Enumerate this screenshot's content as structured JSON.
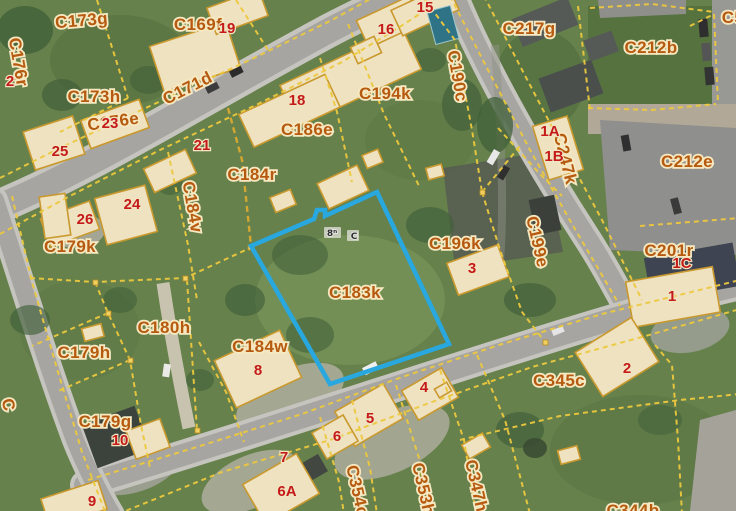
{
  "map": {
    "type": "cadastral-aerial-map",
    "highlight_parcel": {
      "label": "C183k",
      "outline_color": "#29a8e0"
    },
    "parcel_labels": [
      {
        "text": "C173g",
        "x": 82,
        "y": 26,
        "rot": -5
      },
      {
        "text": "C169f",
        "x": 198,
        "y": 30,
        "rot": 0
      },
      {
        "text": "C176r",
        "x": 13,
        "y": 63,
        "rot": 80
      },
      {
        "text": "C173h",
        "x": 94,
        "y": 102,
        "rot": 0
      },
      {
        "text": "C171d",
        "x": 190,
        "y": 93,
        "rot": -27
      },
      {
        "text": "C176e",
        "x": 114,
        "y": 127,
        "rot": -8
      },
      {
        "text": "C194k",
        "x": 385,
        "y": 99,
        "rot": 0
      },
      {
        "text": "C190c",
        "x": 452,
        "y": 77,
        "rot": 80
      },
      {
        "text": "C186e",
        "x": 307,
        "y": 135,
        "rot": 0
      },
      {
        "text": "C217g",
        "x": 529,
        "y": 34,
        "rot": 0
      },
      {
        "text": "C212b",
        "x": 651,
        "y": 53,
        "rot": 0
      },
      {
        "text": "C212e",
        "x": 687,
        "y": 167,
        "rot": 0
      },
      {
        "text": "C247k",
        "x": 560,
        "y": 160,
        "rot": 76
      },
      {
        "text": "C201r",
        "x": 669,
        "y": 256,
        "rot": 0
      },
      {
        "text": "C184r",
        "x": 252,
        "y": 180,
        "rot": 0
      },
      {
        "text": "C179k",
        "x": 70,
        "y": 252,
        "rot": 0
      },
      {
        "text": "C184v",
        "x": 187,
        "y": 208,
        "rot": 80
      },
      {
        "text": "C196k",
        "x": 455,
        "y": 249,
        "rot": 0
      },
      {
        "text": "C199e",
        "x": 532,
        "y": 243,
        "rot": 77
      },
      {
        "text": "C183k",
        "x": 355,
        "y": 298,
        "rot": 0
      },
      {
        "text": "C180h",
        "x": 164,
        "y": 333,
        "rot": 0
      },
      {
        "text": "C179h",
        "x": 84,
        "y": 358,
        "rot": 0
      },
      {
        "text": "C184w",
        "x": 260,
        "y": 352,
        "rot": 0
      },
      {
        "text": "C179g",
        "x": 105,
        "y": 427,
        "rot": 0
      },
      {
        "text": "C345c",
        "x": 559,
        "y": 386,
        "rot": 0
      },
      {
        "text": "C354c",
        "x": 352,
        "y": 492,
        "rot": 77
      },
      {
        "text": "C353h",
        "x": 418,
        "y": 490,
        "rot": 77
      },
      {
        "text": "C347h",
        "x": 471,
        "y": 487,
        "rot": 77
      },
      {
        "text": "C344b",
        "x": 633,
        "y": 516,
        "rot": 0
      }
    ],
    "label_fragments": [
      {
        "text": "C5",
        "x": 733,
        "y": 23,
        "rot": 0
      },
      {
        "text": "C",
        "x": 3,
        "y": 406,
        "rot": 78
      }
    ],
    "red_numbers": [
      {
        "text": "19",
        "x": 227,
        "y": 33
      },
      {
        "text": "2",
        "x": 10,
        "y": 86
      },
      {
        "text": "23",
        "x": 110,
        "y": 128
      },
      {
        "text": "25",
        "x": 60,
        "y": 156
      },
      {
        "text": "15",
        "x": 425,
        "y": 12
      },
      {
        "text": "16",
        "x": 386,
        "y": 34
      },
      {
        "text": "18",
        "x": 297,
        "y": 105
      },
      {
        "text": "21",
        "x": 202,
        "y": 150
      },
      {
        "text": "24",
        "x": 132,
        "y": 209
      },
      {
        "text": "26",
        "x": 85,
        "y": 224
      },
      {
        "text": "1A",
        "x": 550,
        "y": 136
      },
      {
        "text": "1B",
        "x": 554,
        "y": 161
      },
      {
        "text": "1C",
        "x": 682,
        "y": 268
      },
      {
        "text": "1",
        "x": 672,
        "y": 301
      },
      {
        "text": "3",
        "x": 472,
        "y": 273
      },
      {
        "text": "2",
        "x": 627,
        "y": 373
      },
      {
        "text": "4",
        "x": 424,
        "y": 392
      },
      {
        "text": "5",
        "x": 370,
        "y": 423
      },
      {
        "text": "6",
        "x": 337,
        "y": 441
      },
      {
        "text": "7",
        "x": 284,
        "y": 462
      },
      {
        "text": "6A",
        "x": 287,
        "y": 496
      },
      {
        "text": "8",
        "x": 258,
        "y": 375
      },
      {
        "text": "10",
        "x": 120,
        "y": 445
      },
      {
        "text": "9",
        "x": 92,
        "y": 506
      }
    ],
    "tiny_markers": [
      {
        "text": "8ⁿ",
        "x": 332,
        "y": 236
      },
      {
        "text": "C",
        "x": 354,
        "y": 239
      }
    ]
  }
}
